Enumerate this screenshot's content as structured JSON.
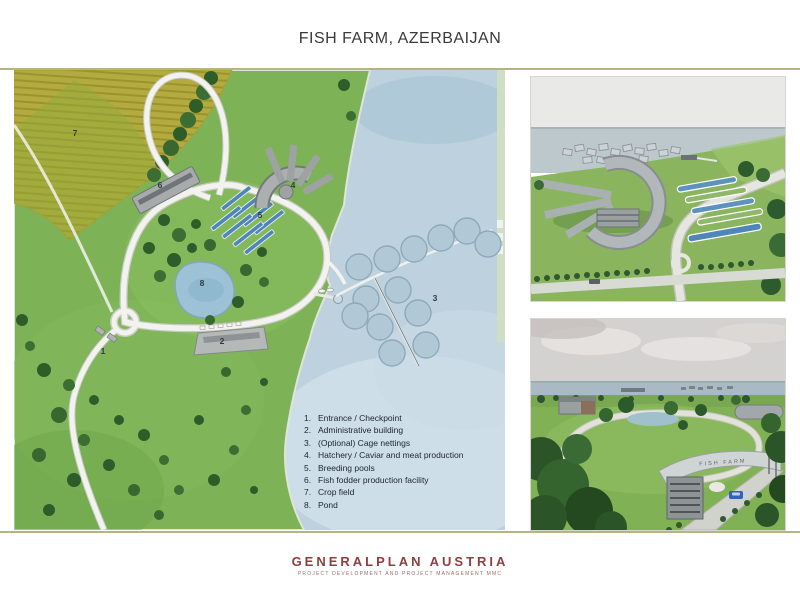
{
  "slide": {
    "title": "FISH FARM, AZERBAIJAN"
  },
  "legend": {
    "items": [
      {
        "num": "1.",
        "label": "Entrance / Checkpoint"
      },
      {
        "num": "2.",
        "label": "Administrative building"
      },
      {
        "num": "3.",
        "label": "(Optional) Cage nettings"
      },
      {
        "num": "4.",
        "label": "Hatchery / Caviar and meat production"
      },
      {
        "num": "5.",
        "label": "Breeding pools"
      },
      {
        "num": "6.",
        "label": "Fish fodder production facility"
      },
      {
        "num": "7.",
        "label": "Crop field"
      },
      {
        "num": "8.",
        "label": "Pond"
      }
    ]
  },
  "map": {
    "markers": [
      "1",
      "2",
      "3",
      "4",
      "5",
      "6",
      "7",
      "8"
    ]
  },
  "renders": {
    "bottom_gate_sign": "FISH FARM"
  },
  "footer": {
    "company": "GENERALPLAN AUSTRIA",
    "tagline": "PROJECT DEVELOPMENT AND PROJECT MANAGEMENT MMC"
  },
  "colors": {
    "accent_line": "#b5b583",
    "brand_red": "#8f3e3e",
    "water": "#bdd2de",
    "land": "#7db356",
    "crop_field": "#b3ab3f",
    "pool_blue": "#4f86b8"
  }
}
